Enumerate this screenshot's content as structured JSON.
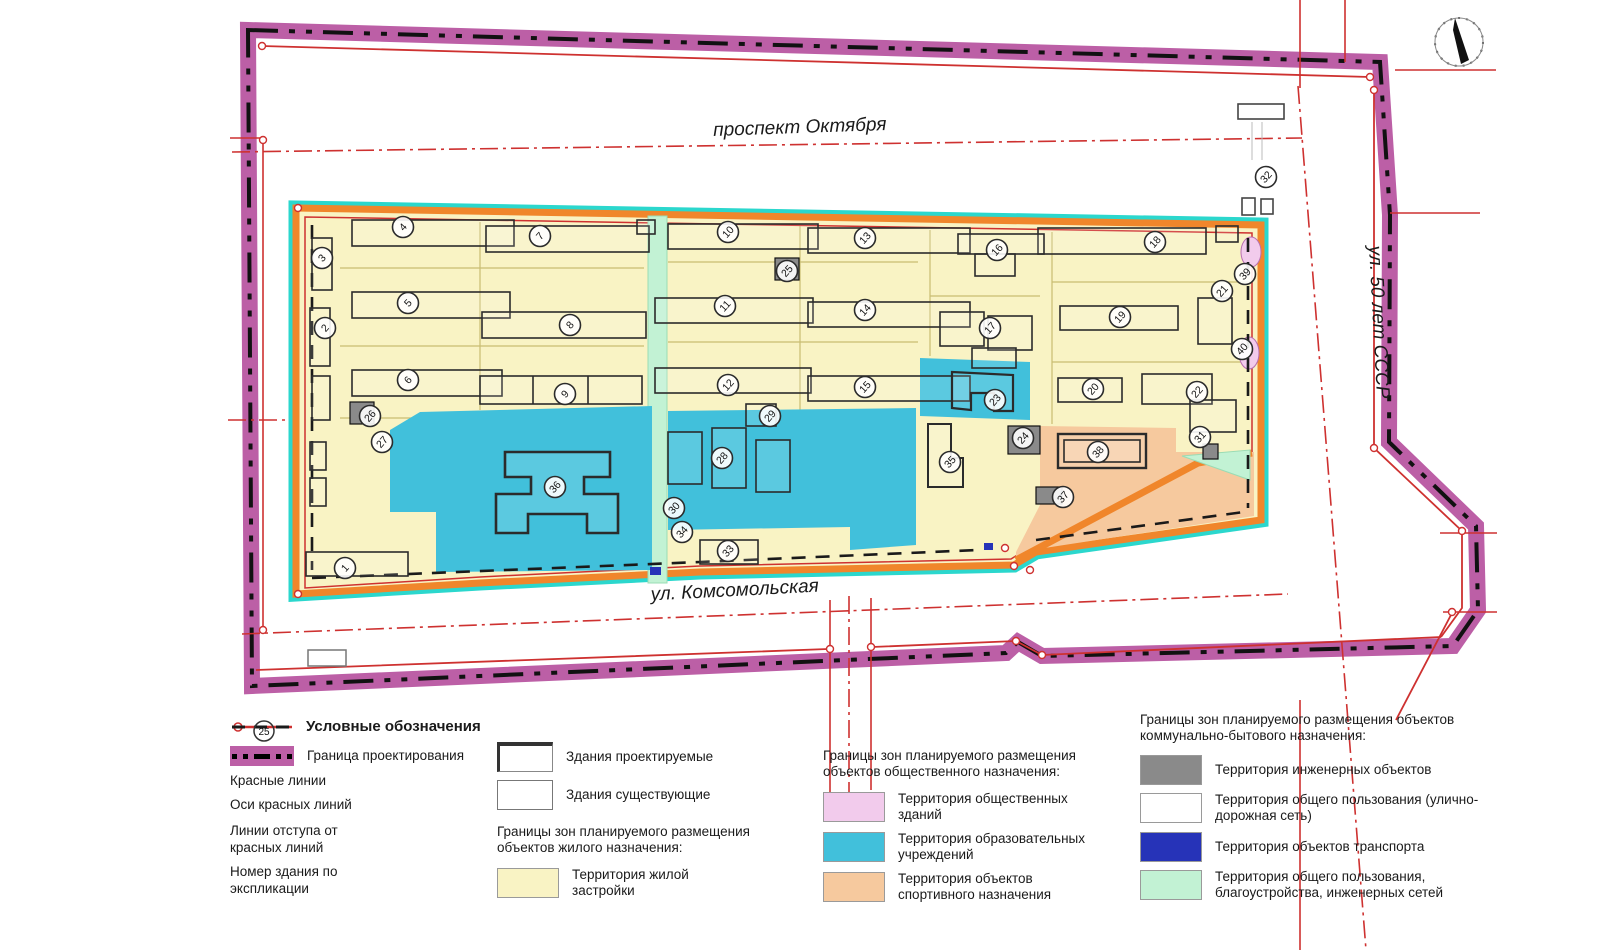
{
  "colors": {
    "boundary_purple": "#BC5FA6",
    "red_line": "#CE3130",
    "block_cyan": "#2BD7CD",
    "block_orange": "#F0862B",
    "residential_yellow": "#F9F3C4",
    "public_pink": "#F2CBEC",
    "education_blue": "#41C0DB",
    "sport_orange": "#F6C99E",
    "engineering_gray": "#8A8A8A",
    "common_white": "#FFFFFF",
    "transport_blue": "#2633B8",
    "green_common": "#C2F2D4",
    "parcel_olive": "#C9BD72"
  },
  "map": {
    "streets": [
      {
        "label": "проспект Октября"
      },
      {
        "label": "ул. Комсомольская"
      },
      {
        "label": "ул. 50 лет СССР"
      }
    ],
    "north_arrow": "north-arrow",
    "buildings": [
      {
        "n": "1",
        "x": 345,
        "y": 568
      },
      {
        "n": "2",
        "x": 325,
        "y": 328
      },
      {
        "n": "3",
        "x": 322,
        "y": 258
      },
      {
        "n": "4",
        "x": 403,
        "y": 227
      },
      {
        "n": "5",
        "x": 408,
        "y": 303
      },
      {
        "n": "6",
        "x": 408,
        "y": 380
      },
      {
        "n": "7",
        "x": 540,
        "y": 236
      },
      {
        "n": "8",
        "x": 570,
        "y": 325
      },
      {
        "n": "9",
        "x": 565,
        "y": 394
      },
      {
        "n": "10",
        "x": 728,
        "y": 232
      },
      {
        "n": "11",
        "x": 725,
        "y": 306
      },
      {
        "n": "12",
        "x": 728,
        "y": 385
      },
      {
        "n": "13",
        "x": 865,
        "y": 238
      },
      {
        "n": "14",
        "x": 865,
        "y": 310
      },
      {
        "n": "15",
        "x": 865,
        "y": 387
      },
      {
        "n": "16",
        "x": 997,
        "y": 250
      },
      {
        "n": "17",
        "x": 990,
        "y": 328
      },
      {
        "n": "18",
        "x": 1155,
        "y": 242
      },
      {
        "n": "19",
        "x": 1120,
        "y": 317
      },
      {
        "n": "20",
        "x": 1093,
        "y": 389
      },
      {
        "n": "21",
        "x": 1222,
        "y": 291
      },
      {
        "n": "22",
        "x": 1197,
        "y": 392
      },
      {
        "n": "23",
        "x": 995,
        "y": 400
      },
      {
        "n": "24",
        "x": 1023,
        "y": 438
      },
      {
        "n": "25",
        "x": 787,
        "y": 271
      },
      {
        "n": "26",
        "x": 370,
        "y": 416
      },
      {
        "n": "27",
        "x": 382,
        "y": 442
      },
      {
        "n": "28",
        "x": 722,
        "y": 458
      },
      {
        "n": "29",
        "x": 770,
        "y": 416
      },
      {
        "n": "30",
        "x": 674,
        "y": 508
      },
      {
        "n": "31",
        "x": 1200,
        "y": 437
      },
      {
        "n": "32",
        "x": 1266,
        "y": 177
      },
      {
        "n": "33",
        "x": 728,
        "y": 551
      },
      {
        "n": "34",
        "x": 682,
        "y": 532
      },
      {
        "n": "35",
        "x": 950,
        "y": 462
      },
      {
        "n": "36",
        "x": 555,
        "y": 487
      },
      {
        "n": "37",
        "x": 1063,
        "y": 497
      },
      {
        "n": "38",
        "x": 1098,
        "y": 452
      },
      {
        "n": "39",
        "x": 1245,
        "y": 274
      },
      {
        "n": "40",
        "x": 1242,
        "y": 349
      }
    ]
  },
  "legend": {
    "title": "Условные обозначения",
    "number_symbol": "25",
    "line_items": [
      {
        "label": "Граница проектирования"
      },
      {
        "label": "Красные линии"
      },
      {
        "label": "Оси красных линий"
      },
      {
        "label": "Линии отступа от красных линий"
      },
      {
        "label": "Номер здания по экспликации"
      }
    ],
    "building_items": [
      {
        "label": "Здания проектируемые"
      },
      {
        "label": "Здания существующие"
      }
    ],
    "residential": {
      "title": "Границы зон планируемого размещения объектов жилого назначения:",
      "items": [
        {
          "label": "Территория жилой застройки"
        }
      ]
    },
    "public": {
      "title": "Границы зон планируемого размещения объектов общественного назначения:",
      "items": [
        {
          "label": "Территория общественных зданий"
        },
        {
          "label": "Территория образовательных учреждений"
        },
        {
          "label": "Территория объектов спортивного назначения"
        }
      ]
    },
    "communal": {
      "title": "Границы зон планируемого размещения объектов коммунально-бытового назначения:",
      "items": [
        {
          "label": "Территория инженерных объектов"
        },
        {
          "label": "Территория общего пользования (улично-дорожная сеть)"
        },
        {
          "label": "Территория объектов транспорта"
        },
        {
          "label": "Территория общего пользования, благоустройства, инженерных сетей"
        }
      ]
    }
  }
}
